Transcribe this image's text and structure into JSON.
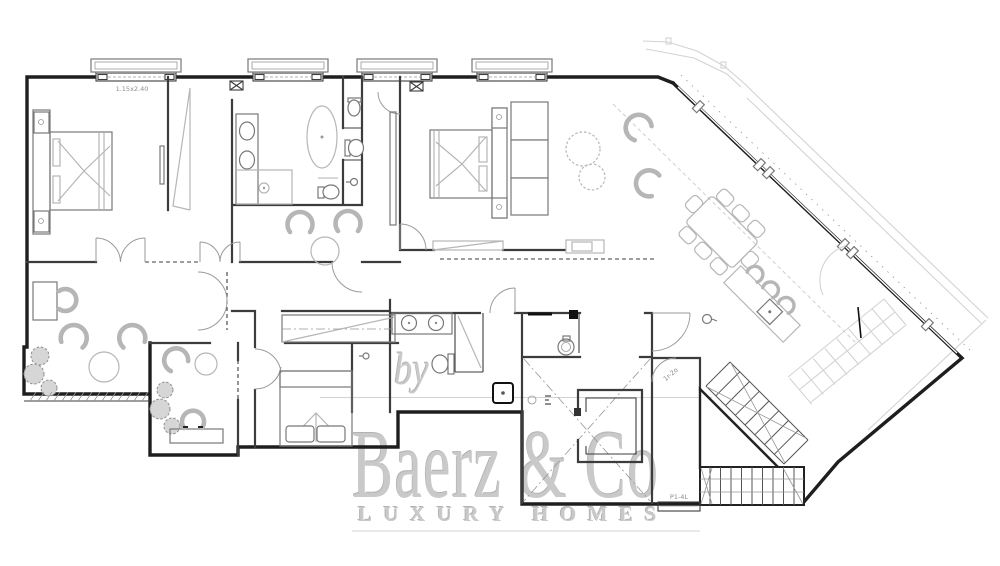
{
  "watermark": {
    "prefix": "by",
    "brand": "Baerz & Co",
    "tagline": "LUXURY HOMES"
  },
  "labels": {
    "window_size": "1.15x2.40",
    "stair_upper": "1r-2o",
    "stair_lower": "P1-4L"
  },
  "colors": {
    "background": "#ffffff",
    "wall": "#1e1e1e",
    "interior_wall": "#3c3c3c",
    "furniture": "#b6b6b6",
    "furniture_dark": "#787878",
    "terrace": "#d3d3d3",
    "watermark": "#c9c9c9",
    "label_text": "#8c8c8c"
  }
}
